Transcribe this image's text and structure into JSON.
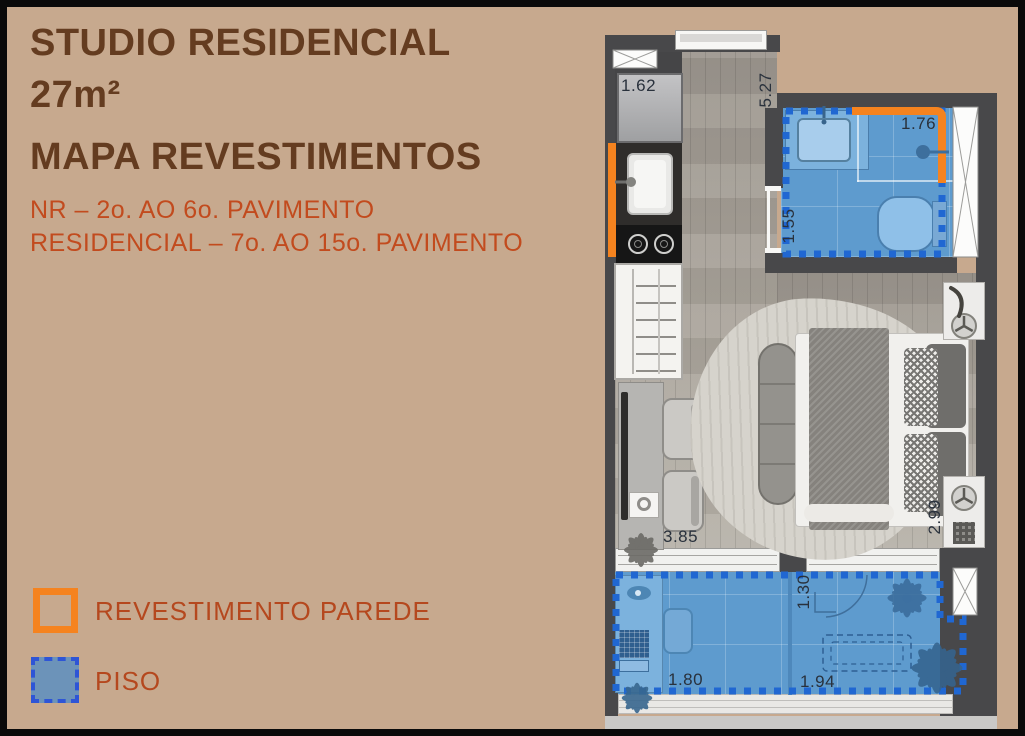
{
  "header": {
    "line1": "STUDIO RESIDENCIAL",
    "line2": "27m²",
    "line3": "MAPA REVESTIMENTOS",
    "sub1": "NR – 2o. AO 6o. PAVIMENTO",
    "sub2": "RESIDENCIAL – 7o. AO 15o. PAVIMENTO"
  },
  "legend": {
    "wall": "REVESTIMENTO PAREDE",
    "floor": "PISO"
  },
  "dims": {
    "fridge": "1.62",
    "hall": "5.27",
    "bath_w": "1.76",
    "bath_d": "1.55",
    "living_w": "3.85",
    "living_d": "2.99",
    "balcony_d": "1.30",
    "balcony_l": "1.80",
    "balcony_r": "1.94"
  },
  "colors": {
    "background": "#c7a98e",
    "frame": "#0a0a0a",
    "title_text": "#643c20",
    "subtitle_text": "#c24b1e",
    "legend_text": "#b5481e",
    "accent_orange": "#f5831f",
    "floor_fill_blue": "#5e9bce",
    "dash_blue": "#2067d2",
    "wall_dark": "#48484a"
  }
}
